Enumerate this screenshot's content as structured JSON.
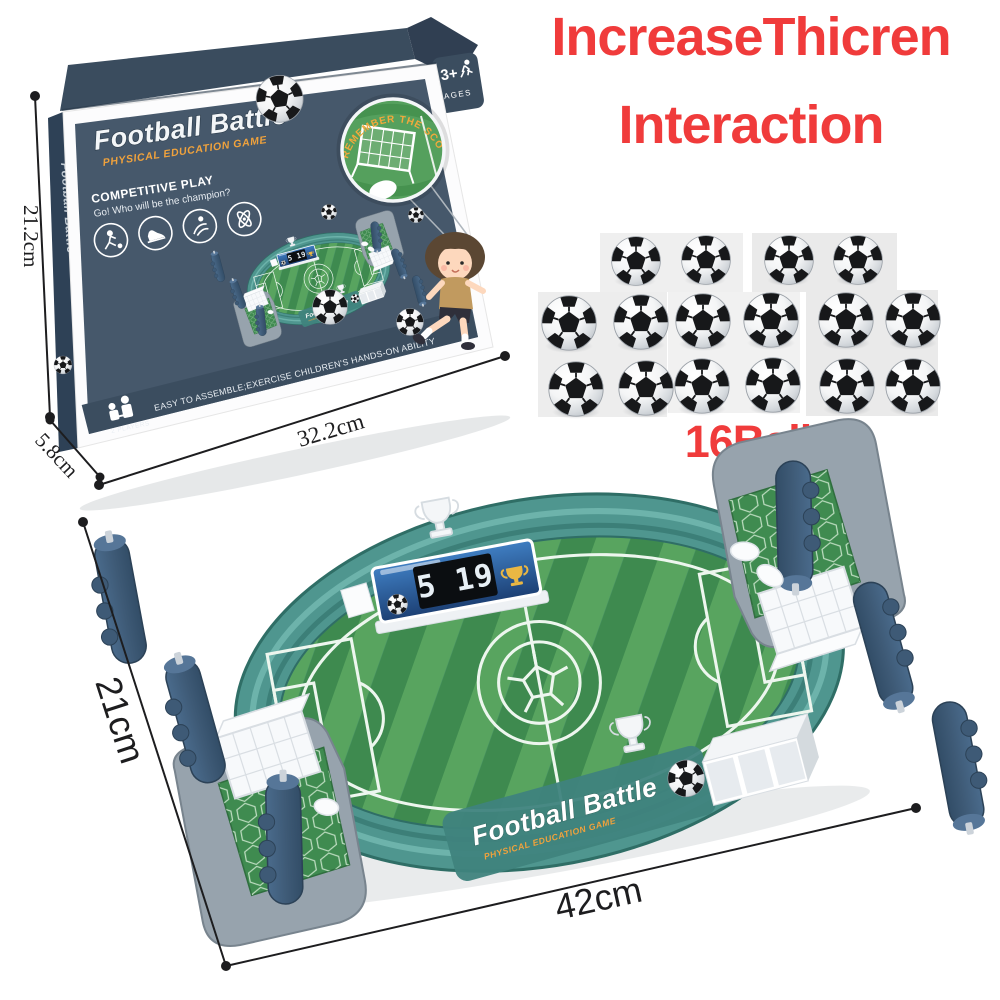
{
  "heading": {
    "line1": "IncreaseThicren",
    "line2": "Interaction",
    "color": "#f03b3b"
  },
  "box": {
    "title": "Football Battle",
    "subtitle": "PHYSICAL EDUCATION GAME",
    "spine_title": "Football Battle",
    "ages_badge": {
      "age": "3+",
      "label": "AGES"
    },
    "magnifier_text": "REMEMBER THE SCORE",
    "competitive_heading": "COMPETITIVE PLAY",
    "competitive_tagline": "Go! Who will be the champion?",
    "bottom_note": "EASY TO ASSEMBLE;EXERCISE CHILDREN'S HANDS-ON ABILITY",
    "players_label": "2 PLAYERS",
    "dimensions": {
      "height": "21.2cm",
      "depth": "5.8cm",
      "width": "32.2cm"
    },
    "feature_icons": [
      "player-kick",
      "sneaker",
      "hand-flick",
      "atom"
    ],
    "colors": {
      "box_navy": "#46586b",
      "lid_navy": "#3a4c5e",
      "accent_orange": "#f0a23c"
    }
  },
  "balls_section": {
    "label": "16Balls",
    "count": 16
  },
  "product": {
    "front_title": "Football Battle",
    "front_subtitle": "PHYSICAL EDUCATION GAME",
    "scoreboard_score": "5 19",
    "dimensions": {
      "height": "21cm",
      "width": "42cm"
    },
    "colors": {
      "wall_teal": "#4f968f",
      "field_green_light": "#58a45f",
      "field_green_dark": "#3e8a4f",
      "handle_navy": "#3e5a76",
      "platform_gray": "#97a3ad"
    }
  }
}
